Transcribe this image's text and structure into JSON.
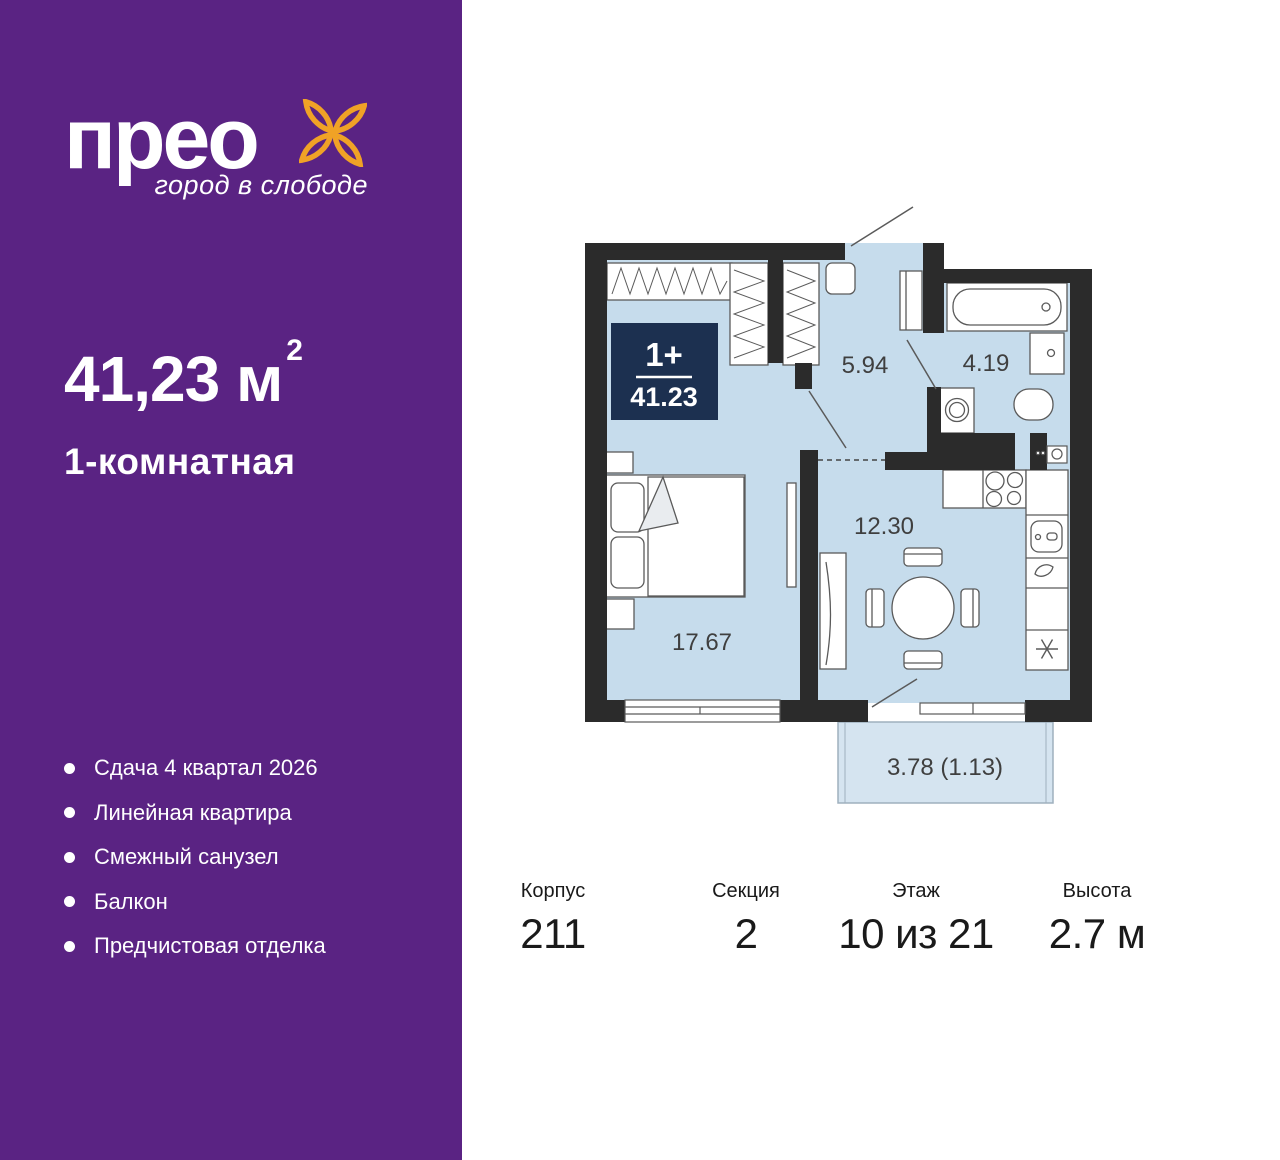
{
  "brand": {
    "logo_text": "прео",
    "tagline": "город в слободе"
  },
  "listing": {
    "area_value": "41,23",
    "area_unit": " м",
    "area_superscript": "2",
    "rooms_title": "1-комнатная"
  },
  "features": [
    "Сдача 4 квартал 2026",
    "Линейная квартира",
    "Смежный санузел",
    "Балкон",
    "Предчистовая отделка"
  ],
  "plan": {
    "badge": {
      "rooms_type": "1+",
      "area": "41.23"
    },
    "rooms": {
      "hallway": "5.94",
      "bathroom": "4.19",
      "kitchen_living": "12.30",
      "bedroom": "17.67",
      "balcony": "3.78 (1.13)"
    }
  },
  "details": {
    "building": {
      "label": "Корпус",
      "value": "211"
    },
    "section": {
      "label": "Секция",
      "value": "2"
    },
    "floor": {
      "label": "Этаж",
      "value": "10 из 21"
    },
    "height": {
      "label": "Высота",
      "value": "2.7 м"
    }
  },
  "colors": {
    "sidebar_purple": "#5A2383",
    "brand_orange": "#F0A226",
    "badge_navy": "#1C3050",
    "room_fill": "#C6DCEC",
    "balcony_fill": "#D5E4F0",
    "wall": "#2B2B2B"
  }
}
